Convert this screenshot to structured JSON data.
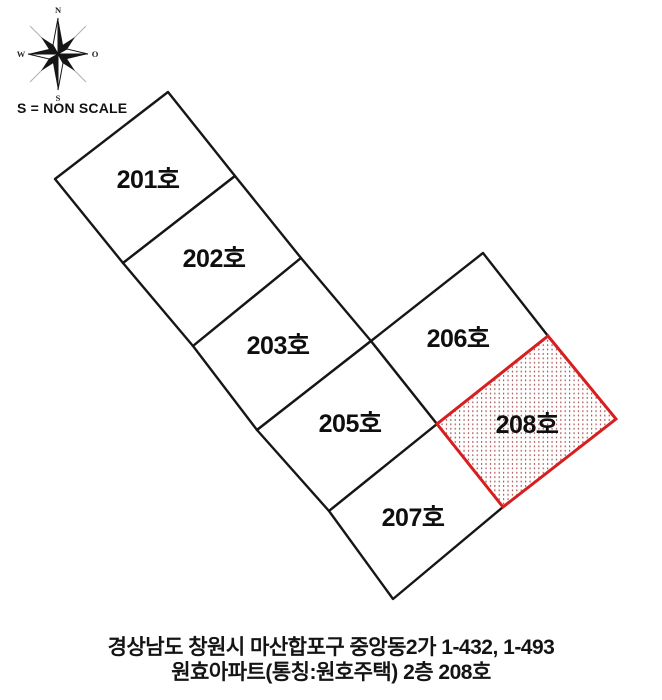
{
  "compass": {
    "north": "N",
    "south": "S",
    "west": "W",
    "east": "O"
  },
  "scale_note": "S = NON SCALE",
  "units": [
    {
      "label": "201호"
    },
    {
      "label": "202호"
    },
    {
      "label": "203호"
    },
    {
      "label": "205호"
    },
    {
      "label": "206호"
    },
    {
      "label": "207호"
    },
    {
      "label": "208호"
    }
  ],
  "highlight": {
    "unit_label": "208호",
    "border_color": "#d81f1f",
    "dot_color": "#a04040"
  },
  "footer": {
    "line1": "경상남도 창원시 마산합포구 중앙동2가 1-432, 1-493",
    "line2": "원효아파트(통칭:원호주택) 2층 208호"
  },
  "colors": {
    "line": "#161616",
    "background": "#ffffff"
  }
}
